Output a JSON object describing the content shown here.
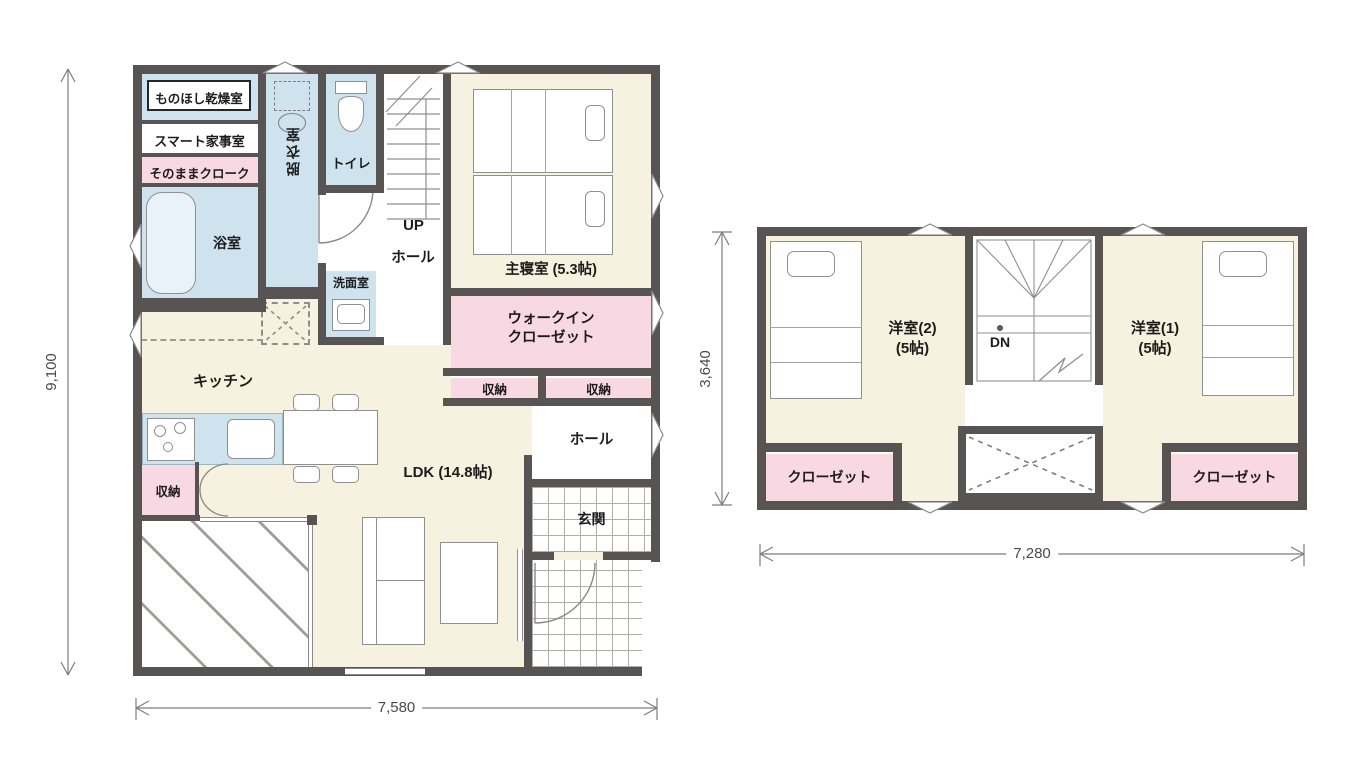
{
  "title": "2-story house floor plan",
  "colors": {
    "wall": "#585454",
    "floor_cream": "#f7f1df",
    "wet_blue": "#cfe3ef",
    "storage_pink": "#f8d8e3"
  },
  "floor1": {
    "labels": {
      "drying_room": "ものほし乾燥室",
      "smart_utility": "スマート家事室",
      "sonomama_cloak": "そのままクローク",
      "bathroom": "浴室",
      "undressing_room": "脱衣室",
      "toilet": "トイレ",
      "stairs_up": "UP",
      "hall_upper": "ホール",
      "washroom": "洗面室",
      "master_bedroom": "主寝室 (5.3帖)",
      "wic_line1": "ウォークイン",
      "wic_line2": "クローゼット",
      "storage_a": "収納",
      "storage_b": "収納",
      "kitchen": "キッチン",
      "storage_c": "収納",
      "ldk": "LDK (14.8帖)",
      "hall_lower": "ホール",
      "entrance": "玄関"
    },
    "dimensions": {
      "height_mm": "9,100",
      "width_mm": "7,580"
    }
  },
  "floor2": {
    "labels": {
      "bedroom2_line1": "洋室(2)",
      "bedroom2_line2": "(5帖)",
      "stairs_down": "DN",
      "bedroom1_line1": "洋室(1)",
      "bedroom1_line2": "(5帖)",
      "closet_left": "クローゼット",
      "closet_right": "クローゼット"
    },
    "dimensions": {
      "height_mm": "3,640",
      "width_mm": "7,280"
    }
  }
}
